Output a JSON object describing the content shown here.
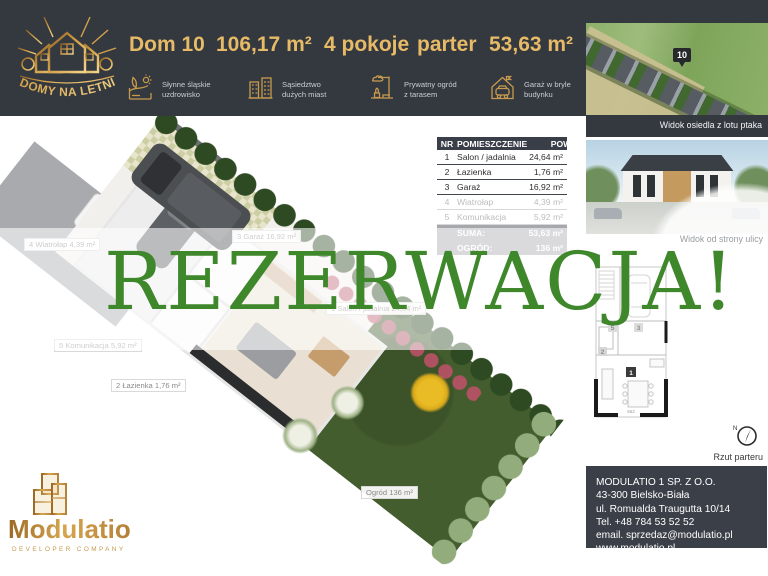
{
  "colors": {
    "header_bg": "#34383f",
    "gold": "#e7ba67",
    "icon_gold": "#c89a4e",
    "overlay_green": "#3e872b",
    "table_header_bg": "#3a3e49",
    "summary_bg": "#929599"
  },
  "logo": {
    "name": "DOMY NA LETNIEJ"
  },
  "header": {
    "title": "Dom 10",
    "area_total": "106,17 m²",
    "rooms": "4 pokoje",
    "floor": "parter",
    "area_usable": "53,63  m²",
    "features": [
      {
        "icon": "spa-icon",
        "line1": "Słynne śląskie",
        "line2": "uzdrowisko"
      },
      {
        "icon": "city-icon",
        "line1": "Sąsiedztwo",
        "line2": "dużych miast"
      },
      {
        "icon": "garden-icon",
        "line1": "Prywatny ogród",
        "line2": "z tarasem"
      },
      {
        "icon": "garage-icon",
        "line1": "Garaż w bryle",
        "line2": "budynku"
      }
    ]
  },
  "table": {
    "columns": [
      "NR",
      "POMIESZCZENIE",
      "POW."
    ],
    "rows": [
      {
        "nr": "1",
        "name": "Salon / jadalnia",
        "area": "24,64 m²"
      },
      {
        "nr": "2",
        "name": "Łazienka",
        "area": "1,76 m²"
      },
      {
        "nr": "3",
        "name": "Garaż",
        "area": "16,92 m²"
      },
      {
        "nr": "4",
        "name": "Wiatrołap",
        "area": "4,39 m²"
      },
      {
        "nr": "5",
        "name": "Komunikacja",
        "area": "5,92 m²"
      }
    ],
    "suma_label": "SUMA:",
    "suma_value": "53,63 m²",
    "ogrod_label": "OGRÓD:",
    "ogrod_value": "136 m²"
  },
  "overlay": {
    "text": "REZERWACJA!"
  },
  "plan_labels": [
    {
      "text": "4 Wiatrołap 4,39 m²"
    },
    {
      "text": "3 Garaż 16,92 m²"
    },
    {
      "text": "5 Komunikacja 5,92 m²"
    },
    {
      "text": "2 Łazienka 1,76 m²"
    },
    {
      "text": "1 Salon / jadalnia 24,64 m²"
    },
    {
      "text": "Ogród 136 m²"
    }
  ],
  "right_column": {
    "caption_aerial": "Widok osiedla z lotu ptaka",
    "unit_marker": "10",
    "caption_street": "Widok od strony ulicy",
    "caption_plan": "Rzut parteru",
    "compass_n": "N",
    "plan_markers": {
      "m1": "1",
      "m2": "2",
      "m3": "3",
      "m5": "5"
    },
    "plan_dimension": "562"
  },
  "contact": {
    "line1": "MODULATIO 1 SP. Z O.O.",
    "line2": "43-300 Bielsko-Biała",
    "line3": "ul. Romualda Traugutta 10/14",
    "line4": "Tel. +48 784 53 52 52",
    "line5": "email. sprzedaz@modulatio.pl",
    "line6": "www.modulatio.pl"
  },
  "footer_logo": {
    "brand": "Modulatio",
    "tagline": "DEVELOPER COMPANY"
  }
}
